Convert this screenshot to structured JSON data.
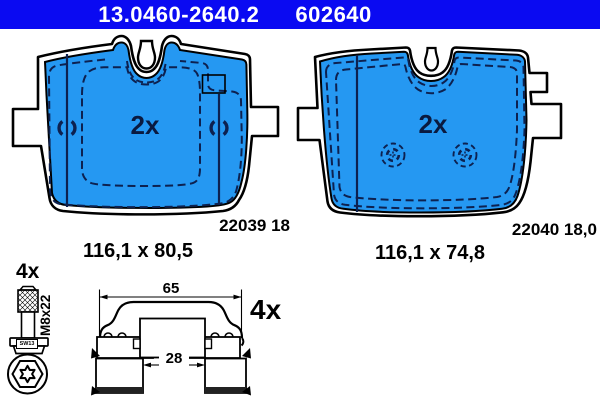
{
  "header": {
    "catalog_number": "13.0460-2640.2",
    "ref_number": "602640",
    "bg_color": "#0a0af2",
    "text_color": "#ffffff"
  },
  "pads": {
    "left": {
      "quantity": "2x",
      "part_code": "22039 18",
      "dimensions": "116,1 x 80,5"
    },
    "right": {
      "quantity": "2x",
      "part_code": "22040 18,0",
      "dimensions": "116,1 x 74,8"
    }
  },
  "hardware": {
    "bolt": {
      "quantity": "4x",
      "thread_spec": "M8x22",
      "wrench_size": "SW13"
    },
    "clip": {
      "quantity": "4x",
      "outer_width_mm": "65",
      "inner_width_mm": "28"
    }
  },
  "colors": {
    "pad_fill": "#2598f2",
    "drawing_dark_blue": "#0d2150",
    "outline_black": "#000000",
    "header_blue": "#0a0af2"
  }
}
